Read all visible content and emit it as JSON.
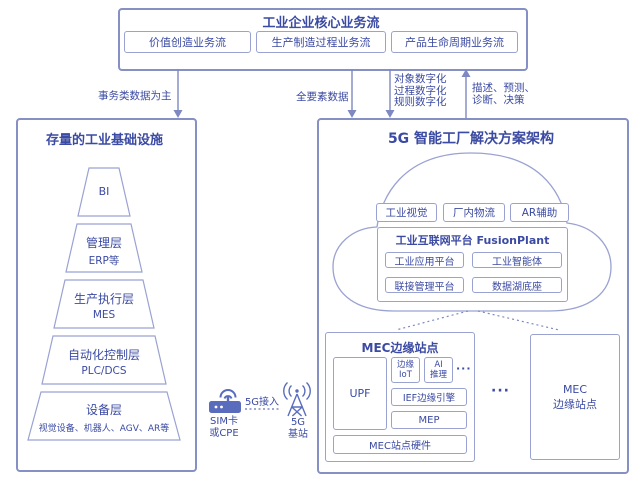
{
  "top_flow": {
    "title": "工业企业核心业务流",
    "items": [
      "价值创造业务流",
      "生产制造过程业务流",
      "产品生命周期业务流"
    ]
  },
  "flows": {
    "transactional": "事务类数据为主",
    "all_factor": "全要素数据",
    "digitization": [
      "对象数字化",
      "过程数字化",
      "规则数字化"
    ],
    "feedback": [
      "描述、预测、",
      "诊断、决策"
    ]
  },
  "legacy": {
    "title": "存量的工业基础设施",
    "pyramid": [
      {
        "name": "BI",
        "detail": ""
      },
      {
        "name": "管理层",
        "detail": "ERP等"
      },
      {
        "name": "生产执行层",
        "detail": "MES"
      },
      {
        "name": "自动化控制层",
        "detail": "PLC/DCS"
      },
      {
        "name": "设备层",
        "detail": "视觉设备、机器人、AGV、AR等"
      }
    ]
  },
  "access": {
    "link_label": "5G接入",
    "cpe": [
      "SIM卡",
      "或CPE"
    ],
    "base_station": [
      "5G",
      "基站"
    ]
  },
  "solution": {
    "title": "5G 智能工厂解决方案架构",
    "cloud_apps": [
      "工业视觉",
      "厂内物流",
      "AR辅助"
    ],
    "platform_title": "工业互联网平台 FusionPlant",
    "platform_modules": [
      "工业应用平台",
      "工业智能体",
      "联接管理平台",
      "数据湖底座"
    ],
    "mec_site": {
      "title": "MEC边缘站点",
      "upf": "UPF",
      "edge_iot": [
        "边缘",
        "IoT"
      ],
      "ai_inference": [
        "AI",
        "推理"
      ],
      "more": "···",
      "ief": "IEF边缘引擎",
      "mep": "MEP",
      "hardware": "MEC站点硬件"
    },
    "sites_ellipsis": "···",
    "mec_site_right": [
      "MEC",
      "边缘站点"
    ]
  },
  "colors": {
    "ink": "#3b4aa2",
    "line": "#9aa2d2",
    "accent": "#5a6dbd"
  }
}
